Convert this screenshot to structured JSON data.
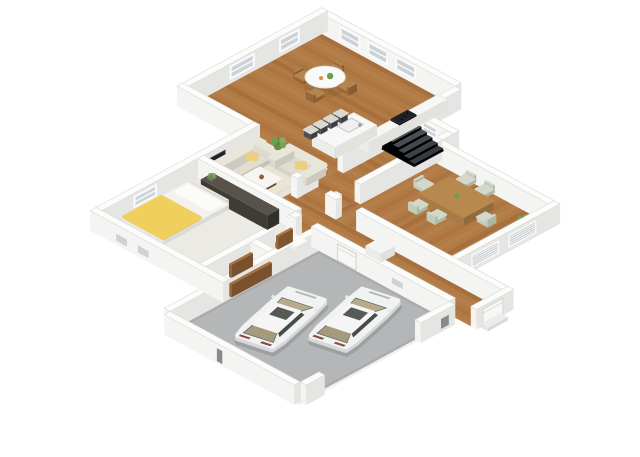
{
  "page": {
    "background": "#ffffff"
  },
  "floorplan": {
    "projection": {
      "cx": 322,
      "cy": 34,
      "sx": 15.5,
      "sy": 8.4,
      "wall_height": 20
    },
    "palette": {
      "background": "#ffffff",
      "wall_top": "#fcfcfb",
      "wall_sw": "#f4f4f2",
      "wall_se": "#e5e5e3",
      "wall_stroke": "#d9d9d6",
      "wood": "#b27a44",
      "carpet": "#ebeae4",
      "concrete": "#b4b6b7",
      "rug": "#e8e4d6",
      "rug_stroke": "#dcd7c6",
      "glass": "#ccd3d7",
      "frame": "#fafafa",
      "louver_base": "#c3c9cd",
      "louver_line": "#eef0f1",
      "slot": "#cfd1d2",
      "slot_dark": "#87898b",
      "door": "#f7f7f5",
      "door_stroke": "#d8d8d6",
      "counter_top": "#f7f7f5",
      "counter_se": "#e2e2df",
      "counter_sw": "#ededea",
      "stove": "#1f2124",
      "stool_seat": "#dad8d2",
      "stool_leg": "#3f3f41",
      "table_white": "#f9f9f7",
      "chair_wood": "#b5854f",
      "dining_table": "#b8894f",
      "dining_chair": "#d2d8ca",
      "sofa": "#e0decf",
      "sofa_back": "#e8e6d9",
      "pillow": "#ecd07b",
      "coffee_base": "#8a5e37",
      "coffee_top": "#f6f5f1",
      "tv": "#1e2124",
      "media": "#f5f5f3",
      "mattress": "#f3f2ee",
      "blanket": "#f1cf5c",
      "pillow_white": "#fbfbf9",
      "wardrobe": "#4a463f",
      "closet_door": "#a8713f",
      "toilet": "#fafaf9",
      "stair_pit": "#26282c",
      "stair_step": "#565a62",
      "car_body": "#f1f2f2",
      "car_lower": "#d5d7d8",
      "car_glass": "#474c46",
      "car_interior": "#b7ab8c",
      "car_interior_rear": "#a69a7e",
      "car_roof": "#f4f5f4",
      "car_shadow": "rgba(45,45,50,0.16)",
      "tail_light": "#8c4a46",
      "grill": "#b4b7b8",
      "plant_greens": [
        "#55823f",
        "#6f9e55",
        "#7fae63",
        "#618f48",
        "#74a45b"
      ],
      "pot": "#7b7468",
      "shadow": "rgba(0,0,0,0.07)"
    },
    "rooms": [
      {
        "name": "room-kitchen-living",
        "floor": "wood",
        "plank": "u",
        "poly": [
          [
            0,
            0
          ],
          [
            8.6,
            0
          ],
          [
            8.6,
            12.6
          ],
          [
            4.6,
            12.6
          ],
          [
            4.6,
            8.6
          ],
          [
            0,
            8.6
          ]
        ]
      },
      {
        "name": "room-corridor",
        "floor": "wood",
        "plank": "u",
        "rect": [
          8.6,
          2.9,
          11.0,
          10.6
        ]
      },
      {
        "name": "room-dining",
        "floor": "wood",
        "plank": "v",
        "rect": [
          11.0,
          4.0,
          18.6,
          10.6
        ]
      },
      {
        "name": "room-hall",
        "floor": "wood",
        "plank": "u",
        "rect": [
          8.6,
          10.6,
          22.2,
          12.6
        ]
      },
      {
        "name": "room-bedroom",
        "floor": "carpet",
        "plank": null,
        "rect": [
          4.6,
          12.6,
          10.9,
          18.8
        ]
      },
      {
        "name": "room-bath",
        "floor": "wood",
        "plank": "v",
        "rect": [
          10.9,
          12.6,
          12.8,
          15.9
        ]
      },
      {
        "name": "room-closet",
        "floor": "wood",
        "plank": "v",
        "rect": [
          10.9,
          15.9,
          12.8,
          18.8
        ]
      },
      {
        "name": "room-garage",
        "floor": "concrete",
        "plank": null,
        "rect": [
          12.8,
          13.0,
          21.2,
          22.6
        ]
      }
    ],
    "walls_back": [
      {
        "name": "wall-north-right",
        "rect": [
          0,
          -0.38,
          8.6,
          0
        ]
      },
      {
        "name": "wall-north-left",
        "rect": [
          -0.38,
          -0.38,
          0,
          8.6
        ]
      },
      {
        "name": "wall-kitchen-ext",
        "rect": [
          8.6,
          0,
          8.98,
          2.9
        ]
      },
      {
        "name": "wall-stairs-top",
        "rect": [
          8.98,
          2.52,
          11.38,
          2.9
        ]
      },
      {
        "name": "wall-stairs-ext",
        "rect": [
          11.0,
          2.9,
          11.38,
          3.62
        ]
      },
      {
        "name": "wall-dining-top",
        "rect": [
          11.38,
          3.62,
          18.6,
          4.0
        ]
      },
      {
        "name": "wall-jog",
        "rect": [
          -0.38,
          8.6,
          4.6,
          8.98
        ]
      },
      {
        "name": "wall-left-long",
        "rect": [
          4.22,
          8.6,
          4.6,
          18.8
        ]
      },
      {
        "name": "wall-main-corridor-a",
        "rect": [
          8.6,
          2.9,
          8.98,
          7.6
        ]
      },
      {
        "name": "wall-main-corridor-b",
        "rect": [
          8.6,
          9.2,
          8.98,
          10.6
        ]
      },
      {
        "name": "wall-dining-left-a",
        "rect": [
          11.0,
          3.62,
          11.38,
          8.9
        ]
      },
      {
        "name": "wall-dining-left-b",
        "rect": [
          11.0,
          10.1,
          11.38,
          10.6
        ]
      }
    ],
    "walls_mid": [
      {
        "name": "wall-dining-right",
        "rect": [
          18.6,
          3.62,
          18.98,
          10.6
        ]
      },
      {
        "name": "wall-hall-top-a",
        "rect": [
          8.6,
          10.22,
          9.0,
          10.6
        ]
      },
      {
        "name": "wall-hall-top-b",
        "rect": [
          10.8,
          10.22,
          11.5,
          10.6
        ]
      },
      {
        "name": "wall-hall-top-c",
        "rect": [
          12.8,
          10.22,
          22.2,
          10.6
        ]
      },
      {
        "name": "wall-hall-end",
        "rect": [
          22.2,
          10.22,
          22.58,
          12.6
        ]
      },
      {
        "name": "wall-bedroom-top",
        "rect": [
          4.6,
          12.22,
          10.9,
          12.6
        ]
      },
      {
        "name": "wall-bedroom-closet-a",
        "rect": [
          10.9,
          12.6,
          11.28,
          13.2
        ]
      },
      {
        "name": "wall-bedroom-closet-b",
        "rect": [
          10.9,
          14.3,
          11.28,
          18.8
        ]
      },
      {
        "name": "wall-closet-divider",
        "rect": [
          11.28,
          15.52,
          12.8,
          15.9
        ]
      },
      {
        "name": "wall-garage-left",
        "rect": [
          12.42,
          12.6,
          12.8,
          22.6
        ]
      },
      {
        "name": "wall-hall-garage-a",
        "rect": [
          10.9,
          12.6,
          11.3,
          13.0
        ]
      },
      {
        "name": "wall-hall-garage-b",
        "rect": [
          12.3,
          12.6,
          21.2,
          13.0
        ]
      }
    ],
    "walls_front": [
      {
        "name": "wall-garage-right-a",
        "rect": [
          21.2,
          13.0,
          21.58,
          15.2
        ]
      },
      {
        "name": "wall-garage-right-b",
        "rect": [
          21.2,
          21.4,
          21.58,
          22.6
        ]
      },
      {
        "name": "wall-garage-bottom",
        "rect": [
          12.8,
          22.6,
          21.2,
          22.98
        ]
      },
      {
        "name": "wall-bedroom-bottom",
        "rect": [
          4.22,
          18.8,
          12.8,
          19.18
        ]
      }
    ],
    "decals": [
      {
        "batch": "back",
        "name": "window-north-1",
        "face": "sw",
        "fixed": 0,
        "span": [
          1.2,
          2.4
        ],
        "z": [
          5,
          17
        ],
        "style": "window"
      },
      {
        "batch": "back",
        "name": "window-north-2",
        "face": "sw",
        "fixed": 0,
        "span": [
          3.0,
          4.2
        ],
        "z": [
          5,
          17
        ],
        "style": "window"
      },
      {
        "batch": "back",
        "name": "window-north-3",
        "face": "sw",
        "fixed": 0,
        "span": [
          4.8,
          6.0
        ],
        "z": [
          5,
          17
        ],
        "style": "window"
      },
      {
        "batch": "back",
        "name": "window-west-1",
        "face": "se",
        "fixed": 0,
        "span": [
          1.5,
          2.7
        ],
        "z": [
          5,
          17
        ],
        "style": "window"
      },
      {
        "batch": "back",
        "name": "window-west-2",
        "face": "se",
        "fixed": 0,
        "span": [
          4.4,
          5.9
        ],
        "z": [
          5,
          17
        ],
        "style": "window"
      },
      {
        "batch": "back",
        "name": "window-stairs",
        "face": "sw",
        "fixed": 2.9,
        "span": [
          9.4,
          10.3
        ],
        "z": [
          6,
          16
        ],
        "style": "window"
      },
      {
        "batch": "back",
        "name": "tv",
        "face": "se",
        "fixed": 4.6,
        "span": [
          10.85,
          12.25
        ],
        "z": [
          7,
          13.5
        ],
        "style": "tv"
      },
      {
        "batch": "back",
        "name": "window-bedroom",
        "face": "se",
        "fixed": 4.6,
        "span": [
          15.3,
          16.7
        ],
        "z": [
          6,
          16
        ],
        "style": "window"
      },
      {
        "batch": "mid",
        "name": "louver-dining-1",
        "face": "se",
        "fixed": 18.98,
        "span": [
          5.2,
          6.9
        ],
        "z": [
          4.5,
          16
        ],
        "style": "louver"
      },
      {
        "batch": "mid",
        "name": "louver-dining-2",
        "face": "se",
        "fixed": 18.98,
        "span": [
          7.6,
          9.3
        ],
        "z": [
          4.5,
          16
        ],
        "style": "louver"
      },
      {
        "batch": "mid",
        "name": "entry-door",
        "face": "se",
        "fixed": 22.58,
        "span": [
          10.9,
          12.2
        ],
        "z": [
          0.5,
          17
        ],
        "style": "door"
      },
      {
        "batch": "mid",
        "name": "garage-hall-door",
        "face": "sw",
        "fixed": 13.0,
        "span": [
          14.0,
          15.2
        ],
        "z": [
          0.5,
          17
        ],
        "style": "door"
      },
      {
        "batch": "mid",
        "name": "garage-panel",
        "face": "sw",
        "fixed": 13.0,
        "span": [
          17.5,
          18.2
        ],
        "z": [
          7,
          13
        ],
        "style": "slot"
      },
      {
        "batch": "front",
        "name": "vent-1",
        "face": "sw",
        "fixed": 19.18,
        "span": [
          5.9,
          6.6
        ],
        "z": [
          4,
          11
        ],
        "style": "slot"
      },
      {
        "batch": "front",
        "name": "vent-2",
        "face": "sw",
        "fixed": 19.18,
        "span": [
          7.3,
          8.0
        ],
        "z": [
          4,
          11
        ],
        "style": "slot"
      },
      {
        "batch": "front",
        "name": "garage-slot-1",
        "face": "se",
        "fixed": 21.58,
        "span": [
          13.4,
          13.9
        ],
        "z": [
          3,
          13
        ],
        "style": "slot_dark"
      },
      {
        "batch": "front",
        "name": "garage-slot-2",
        "face": "sw",
        "fixed": 22.98,
        "span": [
          16.2,
          16.55
        ],
        "z": [
          2,
          15
        ],
        "style": "slot_dark"
      }
    ],
    "stairs": {
      "rect": [
        8.75,
        3.0,
        10.9,
        4.95
      ],
      "steps": 6
    },
    "kitchen": {
      "counter": [
        8.0,
        0.5,
        8.6,
        5.6
      ],
      "counter_h": 11,
      "stove": [
        8.02,
        2.5,
        8.6,
        3.6
      ],
      "island": [
        6.35,
        4.3,
        7.85,
        7.0
      ],
      "island_h": 11,
      "sink": [
        6.62,
        4.72,
        7.38,
        5.66
      ],
      "stools": [
        [
          5.72,
          4.5
        ],
        [
          5.72,
          5.15
        ],
        [
          5.72,
          5.8
        ],
        [
          5.72,
          6.45
        ]
      ],
      "stool_size": 0.22
    },
    "breakfast": {
      "table_c": [
        3.2,
        3.0
      ],
      "table_r": 0.92,
      "chairs": [
        [
          2.15,
          3.35,
          "-x"
        ],
        [
          2.75,
          2.0,
          "-y"
        ],
        [
          4.15,
          2.55,
          "+x"
        ],
        [
          3.6,
          4.0,
          "+y"
        ]
      ]
    },
    "dining": {
      "table": [
        13.2,
        4.95,
        16.0,
        6.85
      ],
      "table_h": 9,
      "chairs": [
        [
          13.55,
          4.3,
          "-y"
        ],
        [
          14.75,
          4.3,
          "-y"
        ],
        [
          13.55,
          7.3,
          "+y"
        ],
        [
          14.75,
          7.3,
          "+y"
        ],
        [
          12.5,
          5.9,
          "-x"
        ],
        [
          16.45,
          5.9,
          "+x"
        ]
      ],
      "plant": [
        17.7,
        4.75
      ]
    },
    "living": {
      "rug": [
        4.9,
        8.5,
        8.3,
        12.2
      ],
      "sofa_a": {
        "rect": [
          4.8,
          8.9,
          6.05,
          12.1
        ],
        "back": "x0"
      },
      "sofa_b": {
        "rect": [
          6.2,
          8.3,
          8.55,
          9.55
        ],
        "back": "y0"
      },
      "pillows": [
        [
          5.5,
          10.0
        ],
        [
          7.6,
          8.95
        ]
      ],
      "coffee_base": [
        6.45,
        10.45,
        7.5,
        11.3
      ],
      "coffee_top": [
        6.3,
        10.32,
        7.65,
        11.42
      ],
      "media": [
        4.6,
        10.8,
        4.98,
        12.3
      ],
      "plant": [
        5.3,
        8.1
      ]
    },
    "bedroom": {
      "bed": [
        4.95,
        13.6,
        7.45,
        17.7
      ],
      "pillows": [
        [
          5.15,
          13.8,
          6.08,
          14.5
        ],
        [
          6.32,
          13.8,
          7.25,
          14.5
        ]
      ],
      "blanket": [
        4.93,
        15.3,
        7.47,
        17.72
      ],
      "wardrobe": [
        5.6,
        12.66,
        9.9,
        13.42
      ],
      "plant": [
        5.95,
        13.04
      ]
    },
    "bath": {
      "toilet": [
        11.5,
        13.15,
        12.05,
        13.75
      ],
      "door": [
        11.28,
        13.3,
        11.42,
        14.25
      ]
    },
    "closet": {
      "doors": [
        [
          11.45,
          16.05,
          11.6,
          17.45
        ],
        [
          12.62,
          16.0,
          12.77,
          18.6
        ]
      ]
    },
    "hall": {
      "cabinet": [
        14.5,
        10.8,
        15.5,
        11.7
      ],
      "step": [
        22.58,
        11.05,
        23.05,
        12.35
      ]
    },
    "garage": {
      "cars": [
        {
          "name": "car-right",
          "c": [
            18.2,
            16.1
          ],
          "angle": -14
        },
        {
          "name": "car-left",
          "c": [
            15.8,
            18.45
          ],
          "angle": -14
        }
      ]
    }
  }
}
